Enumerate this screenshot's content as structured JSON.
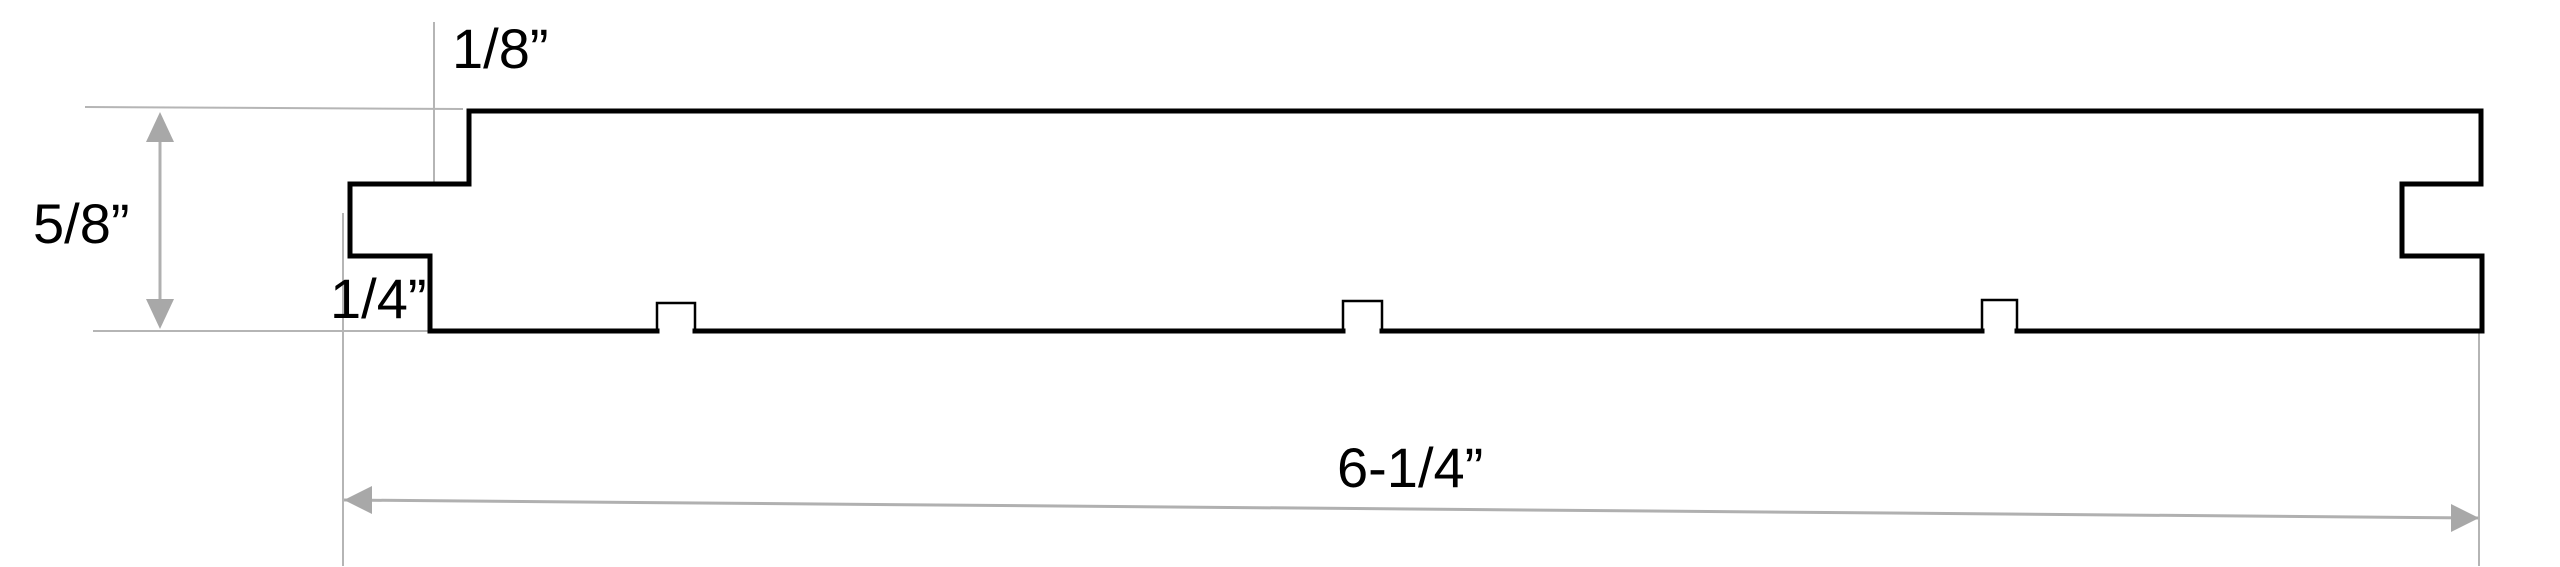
{
  "diagram": {
    "labels": {
      "edge_offset": "1/8”",
      "thickness": "5/8”",
      "tongue": "1/4”",
      "overall_width": "6-1/4”"
    },
    "colors": {
      "outline": "#000000",
      "reference_line": "#b5b5b5",
      "dimension_line": "#b0b0b0",
      "arrow": "#a8a8a8",
      "label_text": "#000000"
    }
  }
}
